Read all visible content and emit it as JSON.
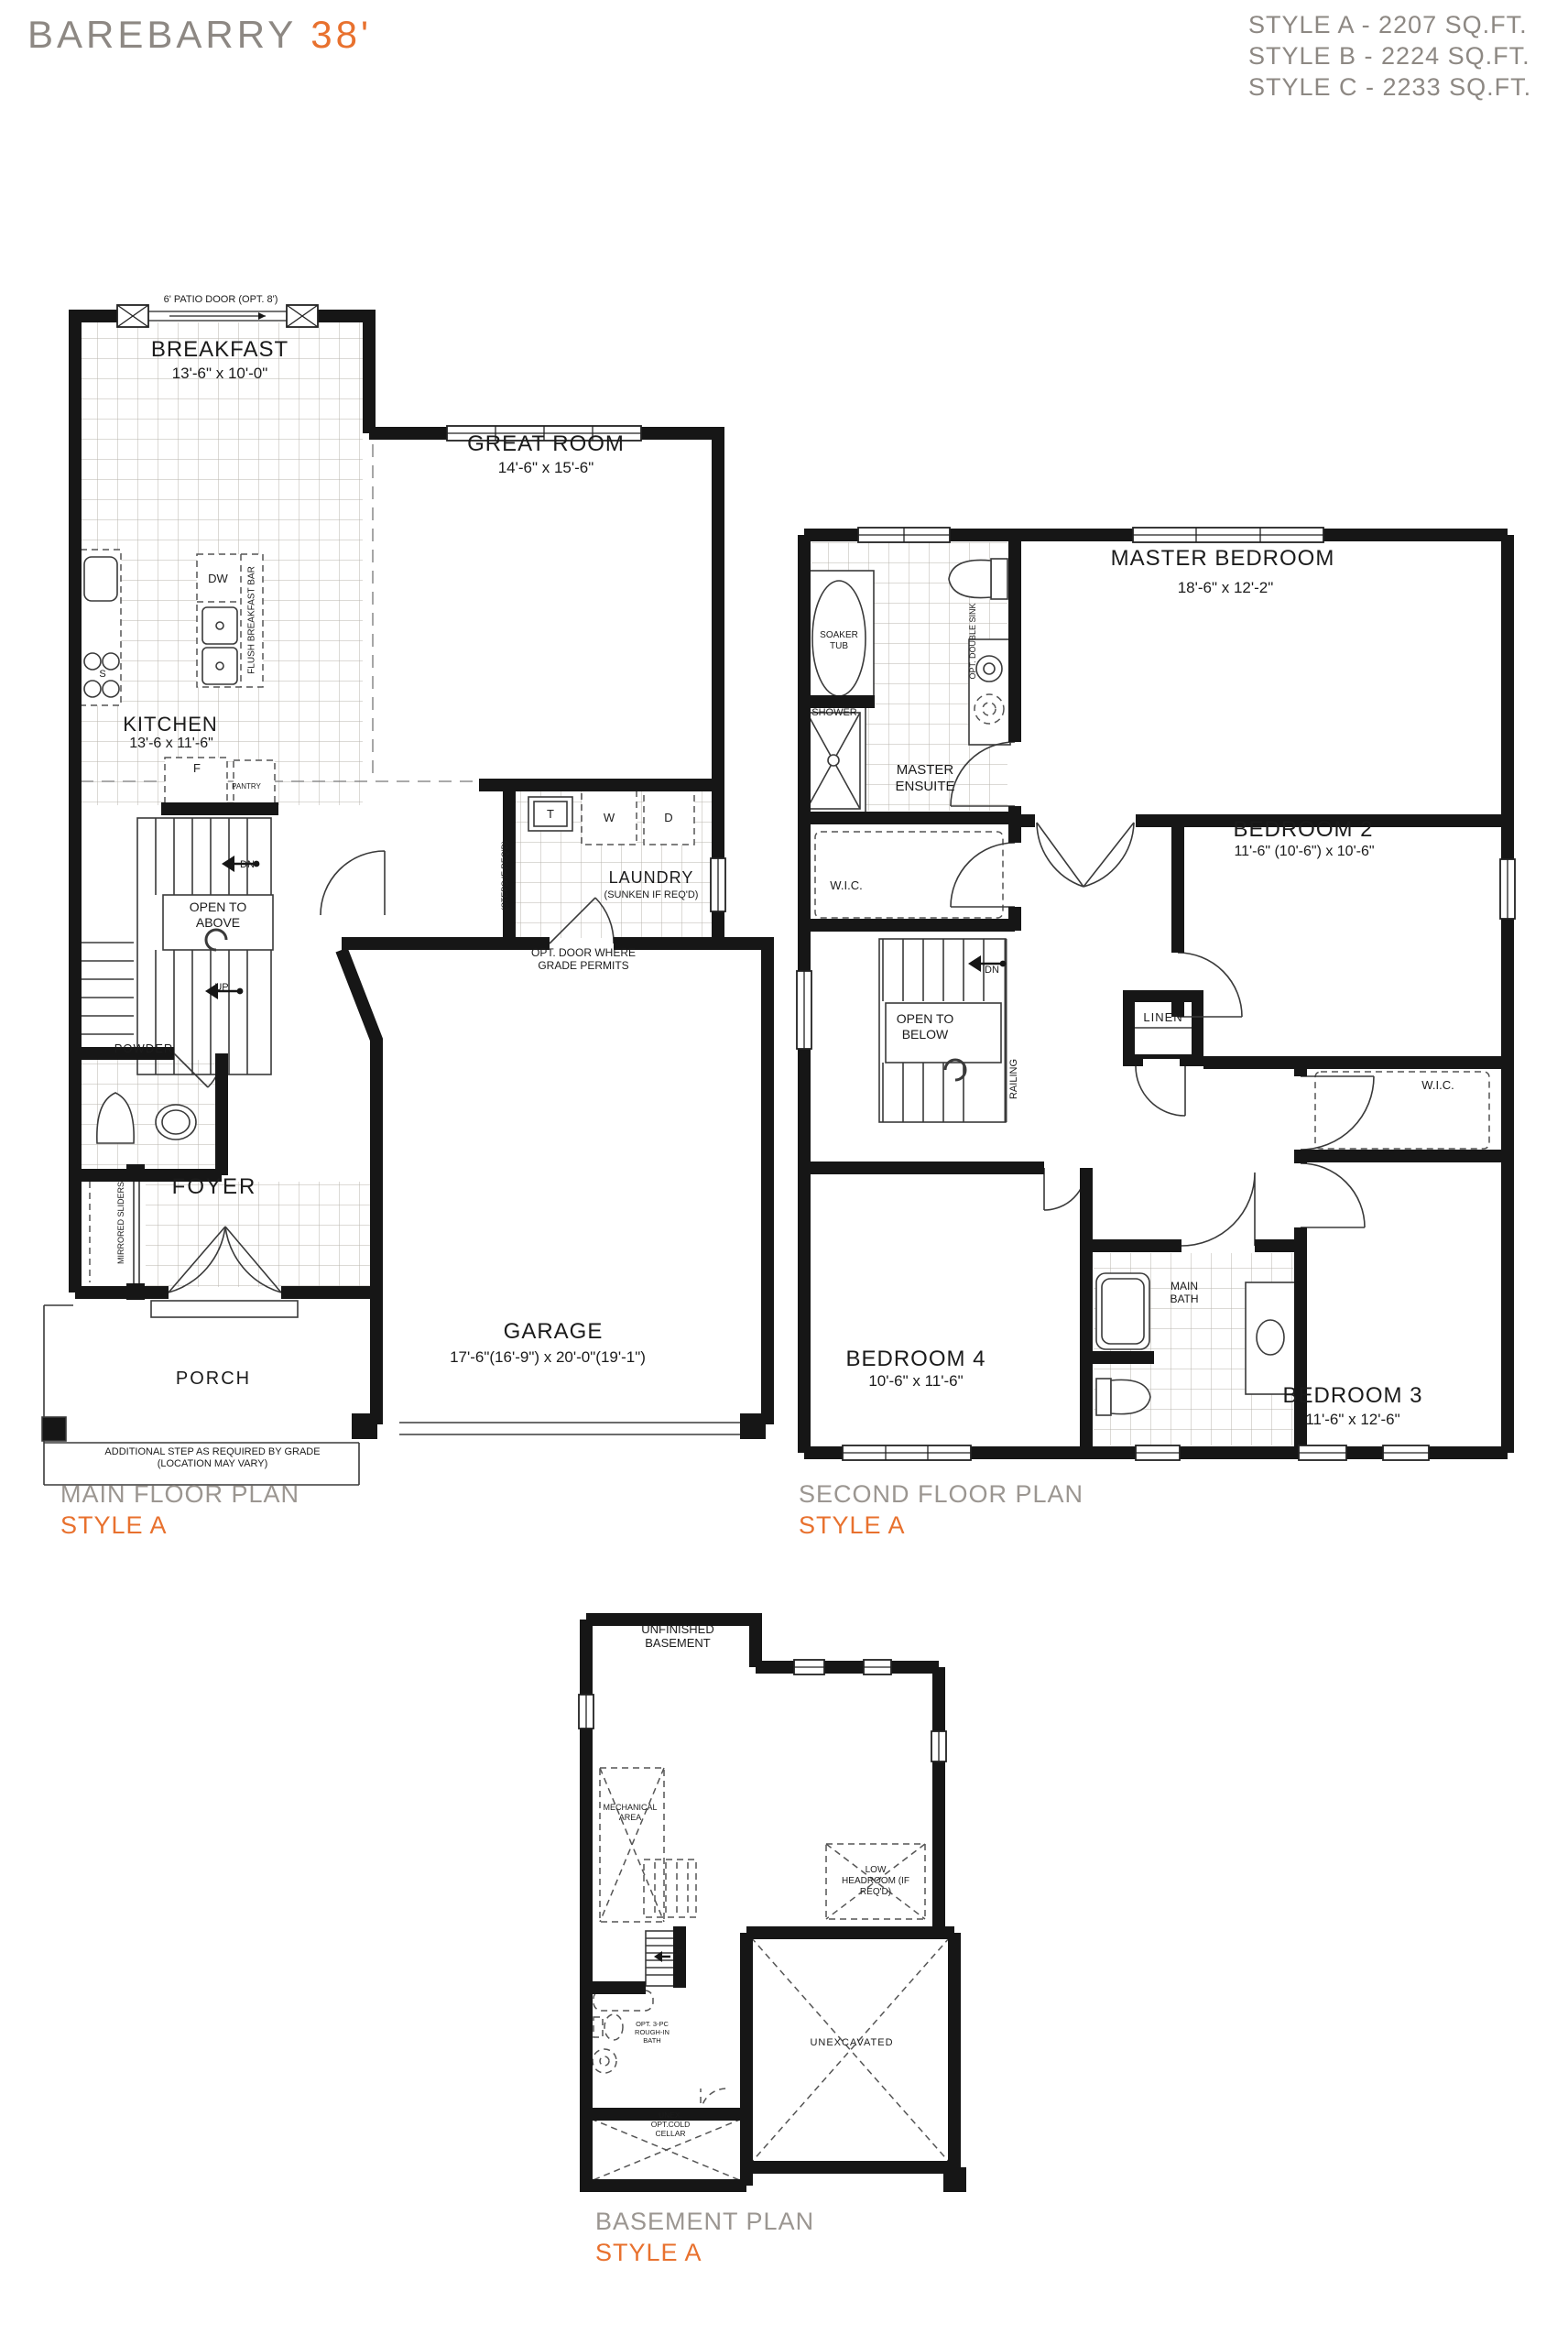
{
  "header": {
    "title": "BAREBARRY",
    "lot": "38'",
    "styles": [
      "STYLE A - 2207 SQ.FT.",
      "STYLE B - 2224 SQ.FT.",
      "STYLE C - 2233 SQ.FT."
    ]
  },
  "plans": {
    "main": {
      "name": "MAIN FLOOR PLAN",
      "style": "STYLE A"
    },
    "second": {
      "name": "SECOND FLOOR PLAN",
      "style": "STYLE A"
    },
    "basement": {
      "name": "BASEMENT PLAN",
      "style": "STYLE A"
    }
  },
  "main_floor": {
    "patio_door": "6' PATIO DOOR (OPT. 8')",
    "breakfast": {
      "name": "BREAKFAST",
      "dims": "13'-6\" x 10'-0\""
    },
    "great_room": {
      "name": "GREAT ROOM",
      "dims": "14'-6\" x 15'-6\""
    },
    "kitchen": {
      "name": "KITCHEN",
      "dims": "13'-6 x 11'-6\""
    },
    "laundry": {
      "name": "LAUNDRY",
      "note": "(SUNKEN IF REQ'D)"
    },
    "garage": {
      "name": "GARAGE",
      "dims": "17'-6\"(16'-9\") x 20'-0\"(19'-1\")"
    },
    "porch": {
      "name": "PORCH"
    },
    "foyer": {
      "name": "FOYER"
    },
    "powder": {
      "name": "POWDER"
    },
    "open_to_above": "OPEN TO ABOVE",
    "labels": {
      "dw": "DW",
      "flush_bar": "FLUSH BREAKFAST BAR",
      "stove": "S",
      "fridge": "F",
      "pantry": "PANTRY",
      "tub": "T",
      "washer": "W",
      "dryer": "D",
      "steps": "(STEPS IF REQ'D)",
      "dn": "DN",
      "up": "UP",
      "mirrored_sliders": "MIRRORED SLIDERS",
      "opt_door": "OPT. DOOR WHERE GRADE PERMITS",
      "step_note": "ADDITIONAL STEP AS REQUIRED BY GRADE (LOCATION MAY VARY)"
    }
  },
  "second_floor": {
    "master": {
      "name": "MASTER BEDROOM",
      "dims": "18'-6\" x 12'-2\""
    },
    "bedroom2": {
      "name": "BEDROOM 2",
      "dims": "11'-6\" (10'-6\") x 10'-6\""
    },
    "bedroom3": {
      "name": "BEDROOM 3",
      "dims": "11'-6\" x 12'-6\""
    },
    "bedroom4": {
      "name": "BEDROOM 4",
      "dims": "10'-6\" x 11'-6\""
    },
    "ensuite": "MASTER ENSUITE",
    "main_bath": "MAIN BATH",
    "labels": {
      "soaker_tub": "SOAKER TUB",
      "shower": "SHOWER",
      "opt_sink": "OPT. DOUBLE SINK",
      "wic_master": "W.I.C.",
      "wic_bed3": "W.I.C.",
      "linen": "LINEN",
      "dn": "DN",
      "open_to_below": "OPEN TO BELOW",
      "railing": "RAILING"
    }
  },
  "basement": {
    "labels": {
      "unfinished": "UNFINISHED BASEMENT",
      "mechanical": "MECHANICAL AREA",
      "low_headroom": "LOW HEADROOM (IF REQ'D)",
      "up": "UP",
      "rough_in": "OPT. 3-PC ROUGH-IN BATH",
      "unexcavated": "UNEXCAVATED",
      "cold_cellar": "UNEX. OPT.COLD CELLAR"
    }
  },
  "colors": {
    "accent": "#E8712E",
    "muted": "#8D8883",
    "ink": "#1B1B1B"
  }
}
